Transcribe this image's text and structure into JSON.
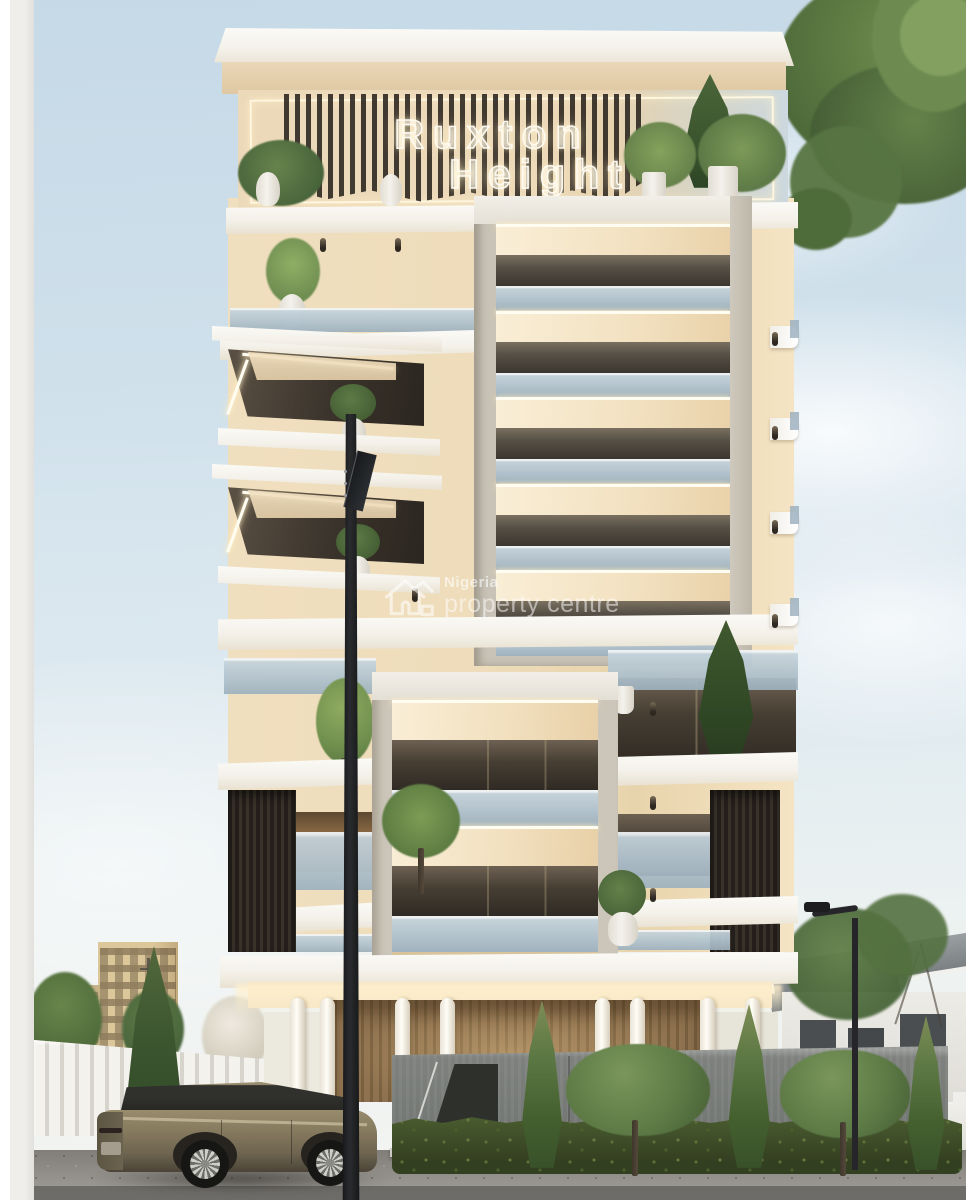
{
  "sign": {
    "line1": "Ruxton",
    "line2": "Height",
    "glow_color": "#fff4d6"
  },
  "watermark": {
    "line1": "Nigeria",
    "line2": "property centre",
    "icon": "house-outline-icon",
    "text_color": "rgba(255,255,255,0.55)"
  },
  "palette": {
    "sky_top": "#c6d9e7",
    "sky_low": "#f3f4f1",
    "wall_cream": "#f2e0be",
    "wall_cream_shade": "#e3cda4",
    "slab_white": "#f7f5f0",
    "led_warm": "#fffdf2",
    "box_frame": "#c9c3b7",
    "dark_interior": "#3b362e",
    "glass_blue": "#b9c9d6",
    "dark_slat": "#2f2a25",
    "wood_slat": "#8a6f4e",
    "stone_wall": "#8e918c",
    "hedge_green": "#3c4a28",
    "tree_green": "#5e7b46",
    "cypress_dark": "#3a5430",
    "asphalt": "#8a8782",
    "car_bronze": "#857a5e",
    "lamp_black": "#141619"
  }
}
